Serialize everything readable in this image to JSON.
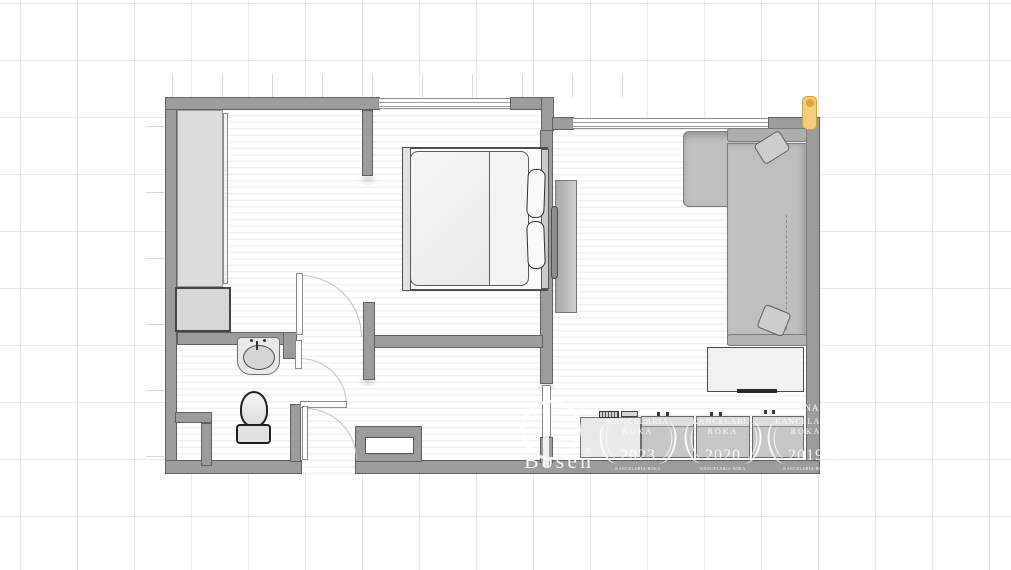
{
  "canvas": {
    "width": 1011,
    "height": 570
  },
  "colors": {
    "wall": "#9c9c9c",
    "wall-border": "#616161",
    "grid-line": "#e8e8e8",
    "floor-stripe": "#f1f1f1",
    "column-accent": "#f2cd7d",
    "column-accent-border": "#cc9f47",
    "watermark": "#ffffff"
  },
  "watermarks": {
    "brand": "Bosen",
    "registered": "®",
    "partial_ring_text": "TNA",
    "stamps": [
      {
        "line1": "KANCELARIA",
        "line2": "ROKA",
        "year": "2023",
        "footer": "KANCELARIA ROKA"
      },
      {
        "line1": "KANCELARIA",
        "line2": "ROKA",
        "year": "2020",
        "footer": "KANCELARIA ROKA"
      },
      {
        "line1": "KANCELARIA",
        "line2": "ROKA",
        "year": "2019",
        "footer": "KANCELARIA ROKA"
      }
    ]
  }
}
